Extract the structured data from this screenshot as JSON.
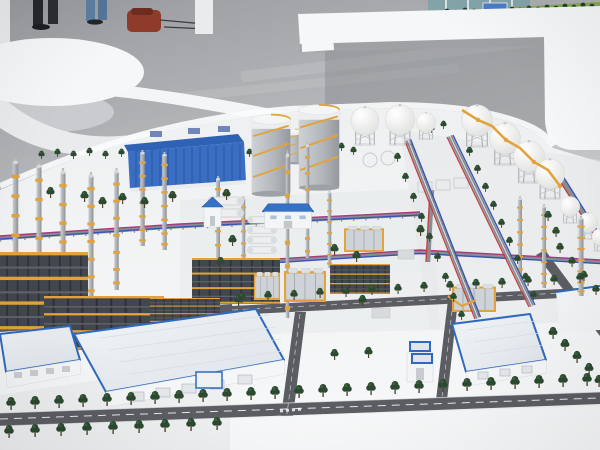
{
  "scene": {
    "type": "photograph",
    "subject": "Physical scale model of a petrochemical refinery complex displayed on a white table in an exhibition hall",
    "environment": "exhibition hall with glossy gray floor, white curved display furniture and a second miniature landscape model on a white bench",
    "people": {
      "count": 2,
      "visibility": "legs only, top-left corner"
    },
    "props": [
      "red-brown bag on floor",
      "white oval display table",
      "white curved ramp edge",
      "white bench with green miniature model"
    ],
    "model_elements": [
      "tall gray distillation columns with golden platform bands",
      "multi-story dark steel process structures with yellow deck edges",
      "large blue ribbed industrial building",
      "two large gray storage silos with white tops and golden spiral stairs",
      "white spherical storage tanks on lattice legs",
      "golden elevated zigzag pipe bridge linking sphere tanks",
      "diagonal pipe racks carrying red and blue pipes",
      "horizontal pipe racks carrying magenta and blue pipes",
      "yellow-framed process modules with silver horizontal drums",
      "white bullet tanks",
      "small white buildings with blue roofs",
      "large white warehouses with blue-trimmed roofs",
      "dark asphalt roads with white lane markings",
      "rows of dark green model trees",
      "white model base with bright curved rim"
    ]
  },
  "palette": {
    "floor_a": "#9c9ea2",
    "floor_b": "#c3c5c8",
    "table_shadow": "#84868a",
    "furniture": "#f6f7f8",
    "base_a": "#eff1f2",
    "rim": "#fbfcfd",
    "tree": "#2b4a2f",
    "tree_hi": "#4a714d",
    "trunk": "#57442f",
    "scaffold": "#e2a33c",
    "steel": "#42464d",
    "steel_line": "#2e3137",
    "roof_blue": "#3572c6",
    "trim_blue": "#2f6ac0",
    "bldg_blue": "#3a6ec2",
    "pipe_red": "#c04040",
    "pipe_blue": "#3454b4",
    "pipe_magenta": "#a83a7a",
    "rack_gray": "#8a8e94",
    "road": "#5c5d62",
    "road_mark": "#ffffff",
    "grass": "#7da34f",
    "bag": "#8e3b2a",
    "jeans": "#5d7fa3",
    "pants": "#26282d",
    "teal": "#7fa3a8",
    "concrete": "#e6e9ea"
  }
}
